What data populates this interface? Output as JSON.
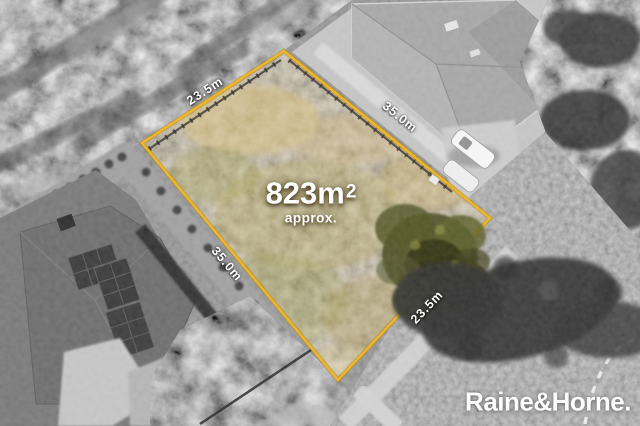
{
  "listing": {
    "area_value": "823m",
    "area_sup": "2",
    "area_approx": "approx.",
    "dimensions": [
      {
        "edge": "top-left",
        "label": "23.5m"
      },
      {
        "edge": "top-right",
        "label": "35.0m"
      },
      {
        "edge": "left",
        "label": "35.0m"
      },
      {
        "edge": "bottom-right",
        "label": "23.5m"
      }
    ],
    "brand": "Raine&Horne."
  },
  "colors": {
    "boundary_gold": "#eeb01f",
    "boundary_gold_dark": "#a87f10",
    "lot_fill": "#b49c6a",
    "label_text": "#ffffff"
  }
}
